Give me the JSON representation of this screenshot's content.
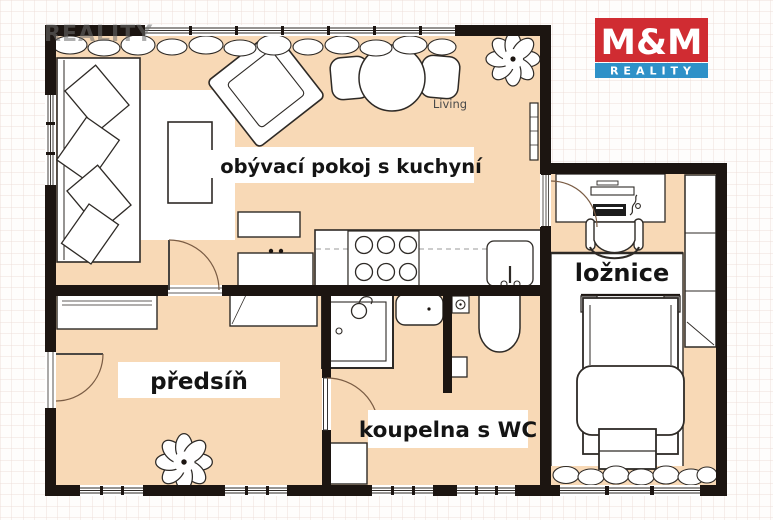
{
  "watermark": {
    "text": "REALITY"
  },
  "logo": {
    "top": "M&M",
    "bottom": "REALITY",
    "red": "#d02c32",
    "blue": "#2e91c8"
  },
  "rooms": {
    "living": {
      "label": "obývací pokoj s kuchyní"
    },
    "bedroom": {
      "label": "ložnice"
    },
    "hallway": {
      "label": "předsíň"
    },
    "bathroom": {
      "label": "koupelna s WC"
    }
  },
  "annotations": {
    "dining": "Living"
  },
  "palette": {
    "floor": "#f8d9b6",
    "wall": "#1c1511",
    "grid_line": "#eddfda",
    "label_text": "#141414"
  }
}
